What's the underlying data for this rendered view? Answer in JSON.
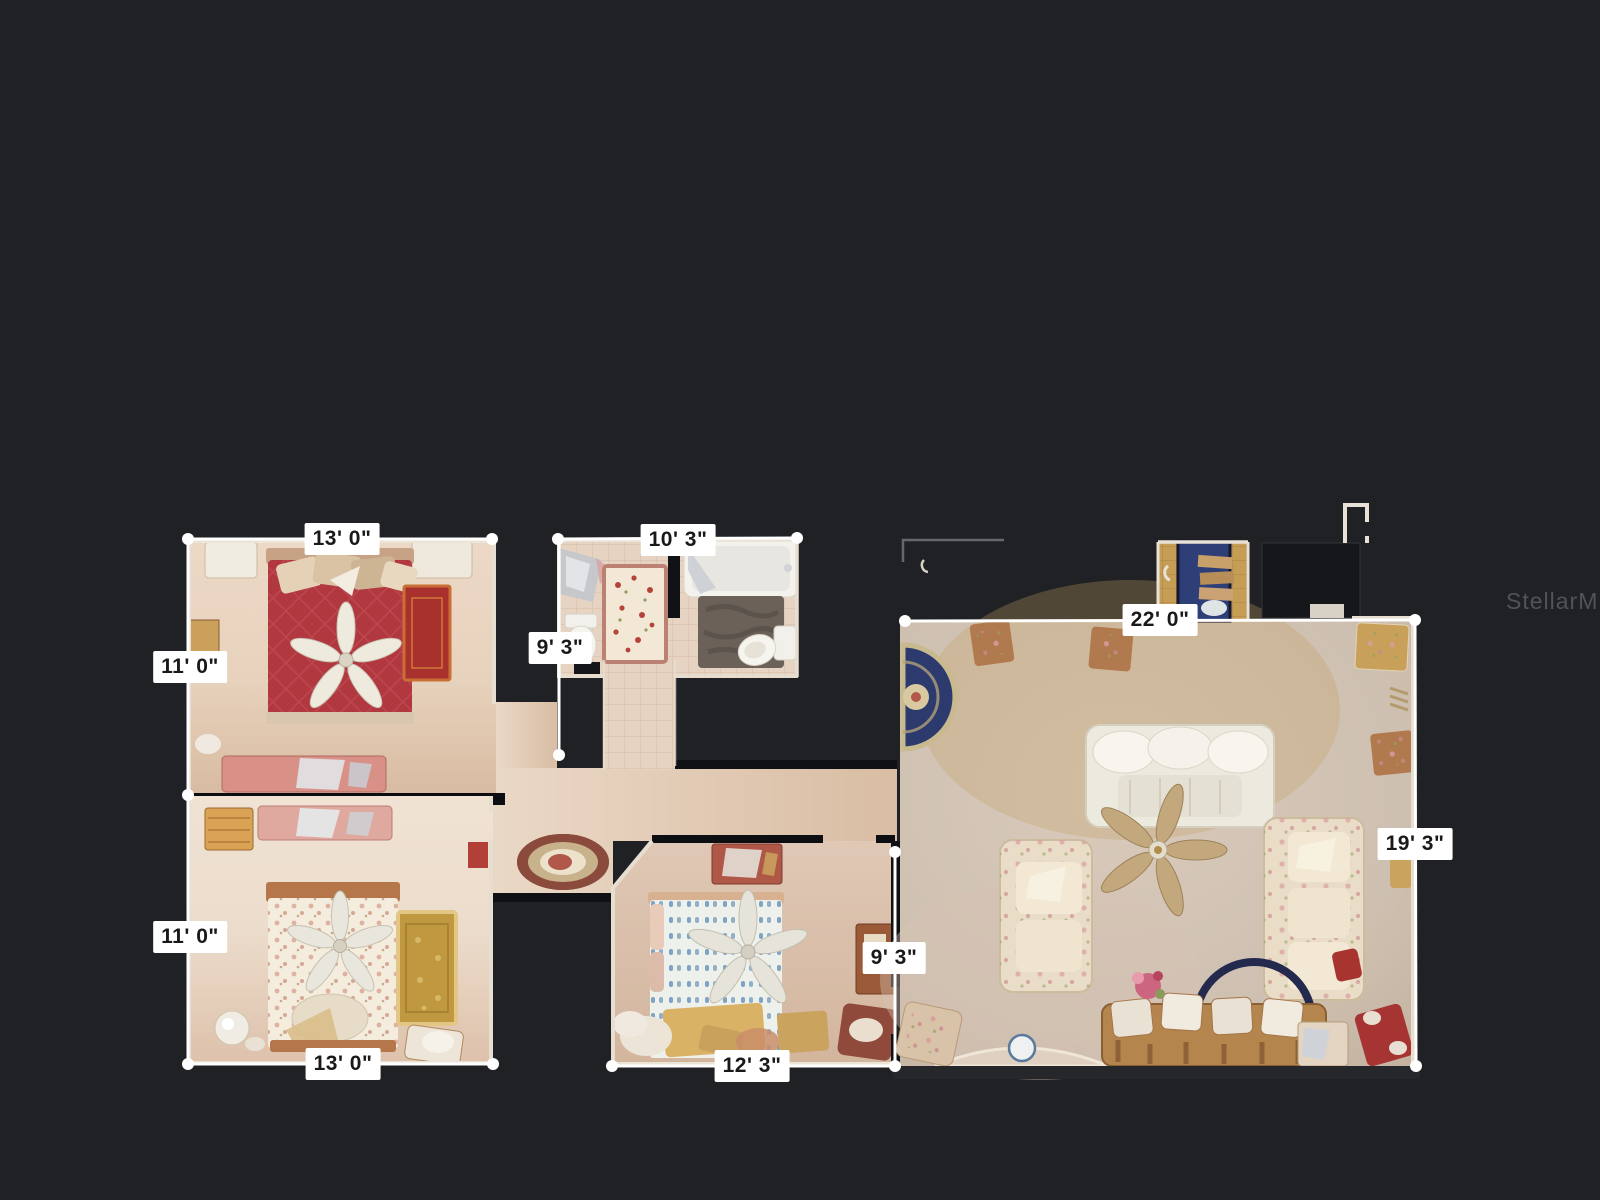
{
  "watermark": "StellarMLS",
  "colors": {
    "background": "#1f2125",
    "measure_line": "#ffffff",
    "label_bg": "#ffffff",
    "label_text": "#191919",
    "watermark_text": "#54565d",
    "floor_beige": "#e4cfba",
    "living_floor": "#cfc0b1",
    "red_bed": "#b23840",
    "navy_rug": "#2c3a6e",
    "gold_rug": "#c0983f"
  },
  "rooms": {
    "bedroom_top_left": {
      "width": "13' 0\"",
      "depth": "11' 0\""
    },
    "bathroom": {
      "width": "10' 3\"",
      "depth": "9' 3\""
    },
    "living_room": {
      "width": "22' 0\"",
      "depth": "19' 3\""
    },
    "bedroom_bottom_left": {
      "width": "13' 0\"",
      "depth": "11' 0\""
    },
    "bedroom_middle": {
      "width": "12' 3\"",
      "depth": "9' 3\""
    }
  },
  "dimensions": [
    {
      "room": "bedroom-top-left",
      "edge": "top",
      "text": "13' 0\""
    },
    {
      "room": "bedroom-top-left",
      "edge": "left",
      "text": "11' 0\""
    },
    {
      "room": "bathroom",
      "edge": "top",
      "text": "10' 3\""
    },
    {
      "room": "bathroom",
      "edge": "left",
      "text": "9' 3\""
    },
    {
      "room": "living-room",
      "edge": "top",
      "text": "22' 0\""
    },
    {
      "room": "living-room",
      "edge": "right",
      "text": "19' 3\""
    },
    {
      "room": "bedroom-bottom-left",
      "edge": "left",
      "text": "11' 0\""
    },
    {
      "room": "bedroom-bottom-left",
      "edge": "bottom",
      "text": "13' 0\""
    },
    {
      "room": "bedroom-middle",
      "edge": "right",
      "text": "9' 3\""
    },
    {
      "room": "bedroom-middle",
      "edge": "bottom",
      "text": "12' 3\""
    }
  ]
}
